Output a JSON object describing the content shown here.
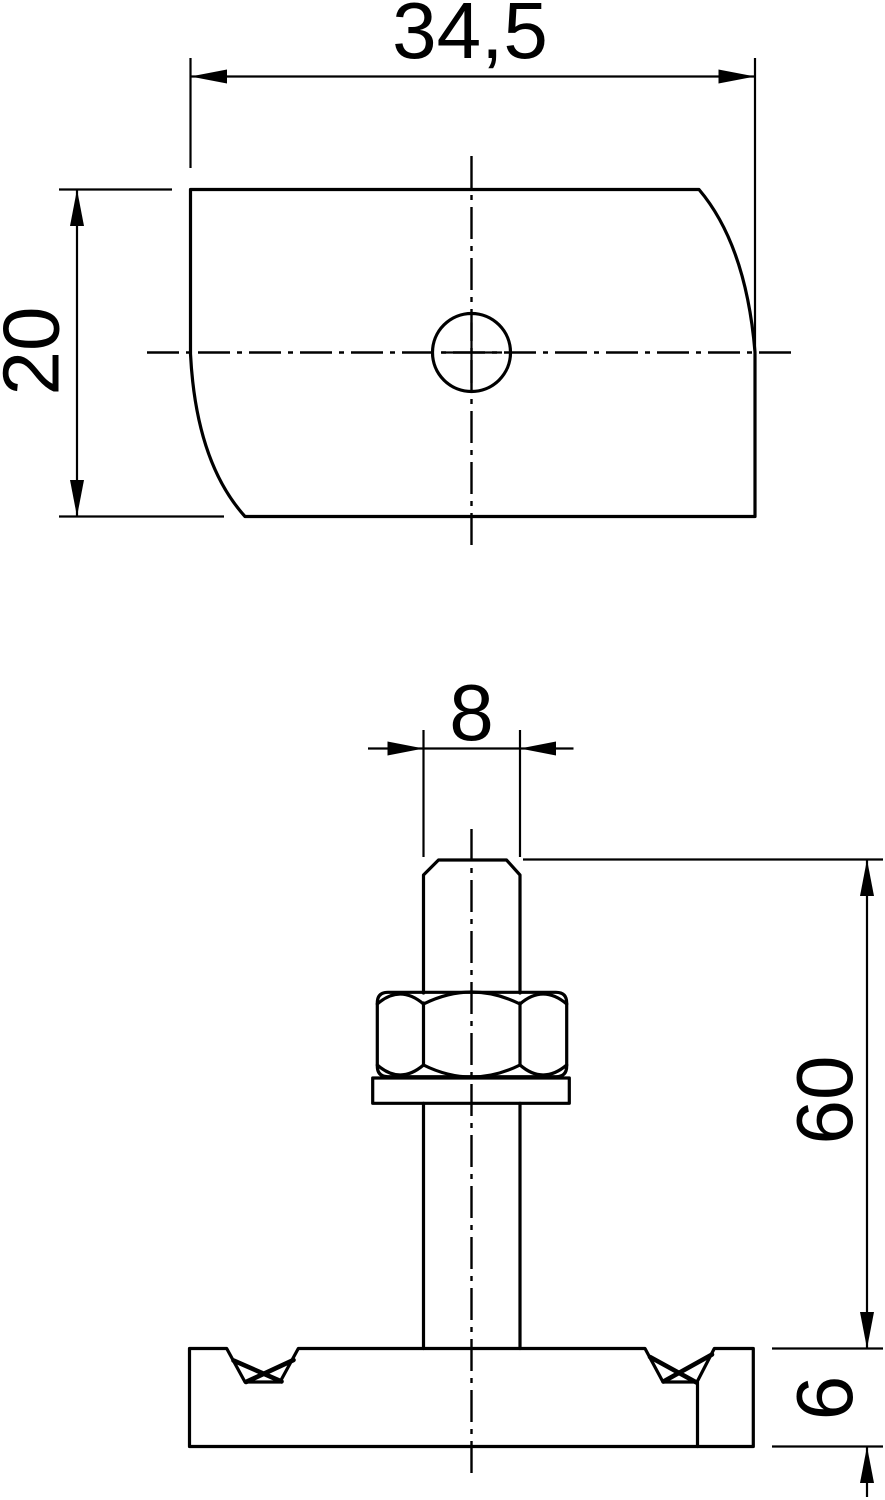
{
  "drawing": {
    "type": "technical-drawing",
    "background_color": "#ffffff",
    "line_color": "#000000",
    "views": {
      "top_view": "slide-nut-plate-with-hole",
      "side_view": "threaded-stud-with-hex-nut-washer-and-base-plate"
    },
    "dimensions": {
      "plate_width": "34,5",
      "plate_depth": "20",
      "stud_diameter": "8",
      "stem_length": "60",
      "plate_thickness": "6"
    }
  }
}
